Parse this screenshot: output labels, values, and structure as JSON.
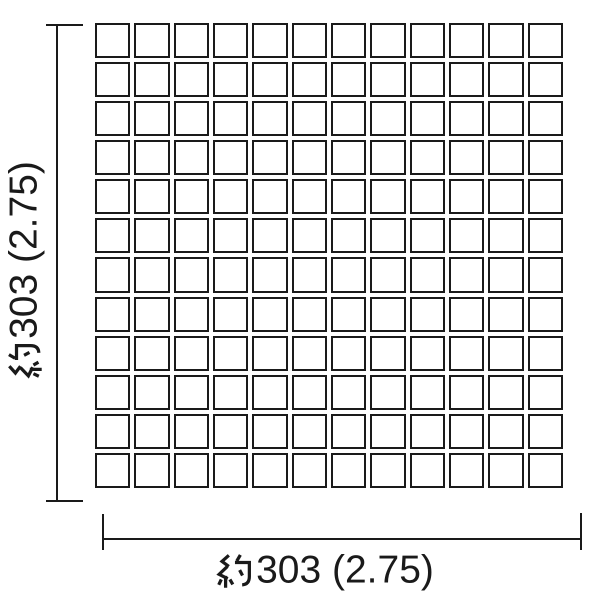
{
  "diagram": {
    "type": "tile-sheet-dimension-drawing",
    "grid": {
      "rows": 12,
      "columns": 12,
      "tile_shape": "square",
      "tile_fill": "#ffffff",
      "line_color": "#1a1a1a"
    },
    "dimension_height": {
      "label": "約303 (2.75)",
      "prefix": "約",
      "value": "303 (2.75)",
      "orientation": "vertical"
    },
    "dimension_width": {
      "label": "約303 (2.75)",
      "prefix": "約",
      "value": "303 (2.75)",
      "orientation": "horizontal"
    },
    "colors": {
      "background": "#ffffff",
      "line": "#1a1a1a"
    }
  }
}
